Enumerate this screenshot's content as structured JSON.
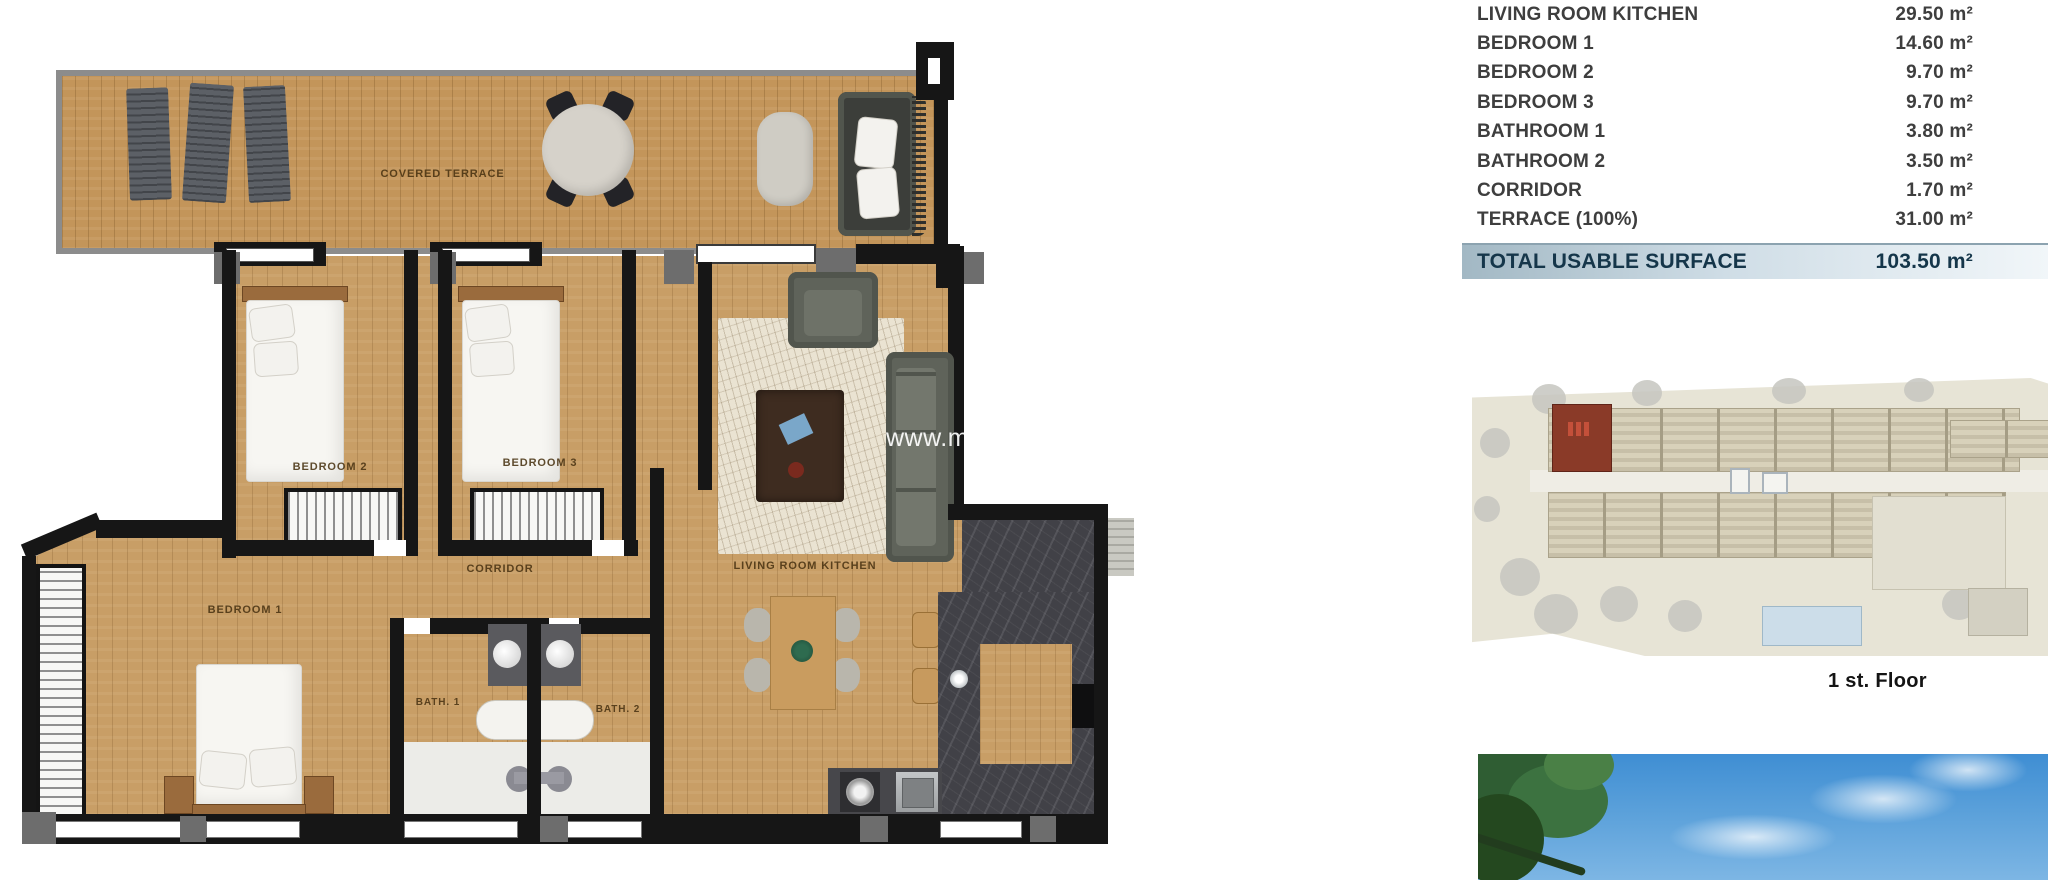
{
  "floor_plan": {
    "labels": {
      "covered_terrace": "COVERED TERRACE",
      "bedroom_1": "BEDROOM 1",
      "bedroom_2": "BEDROOM 2",
      "bedroom_3": "BEDROOM 3",
      "corridor": "CORRIDOR",
      "living_room_kitchen": "LIVING ROOM KITCHEN",
      "bath_1": "BATH. 1",
      "bath_2": "BATH. 2"
    },
    "watermark": "www.me"
  },
  "surface_table": {
    "rows": [
      {
        "label": "LIVING ROOM KITCHEN",
        "value": "29.50 m²"
      },
      {
        "label": "BEDROOM 1",
        "value": "14.60 m²"
      },
      {
        "label": "BEDROOM 2",
        "value": "9.70 m²"
      },
      {
        "label": "BEDROOM 3",
        "value": "9.70 m²"
      },
      {
        "label": "BATHROOM 1",
        "value": "3.80 m²"
      },
      {
        "label": "BATHROOM 2",
        "value": "3.50 m²"
      },
      {
        "label": "CORRIDOR",
        "value": "1.70 m²"
      },
      {
        "label": "TERRACE (100%)",
        "value": "31.00 m²"
      }
    ],
    "total_label": "TOTAL USABLE SURFACE",
    "total_value": "103.50 m²"
  },
  "site_plan": {
    "caption": "1 st. Floor",
    "highlight_color": "#8a3a28"
  },
  "colors": {
    "wall": "#161616",
    "wood_floor": "#c89e66",
    "terrace_wood": "#c3955a",
    "plan_label_text": "#4a3413",
    "table_text": "#3e3e3e",
    "total_bar_text": "#15364a",
    "total_bar_gradient": "#a2b8c4 → #f1f6f9",
    "site_background": "#e7e4d6",
    "pool_blue": "#ccdde9",
    "sky_blue": "#4f9ad6"
  }
}
